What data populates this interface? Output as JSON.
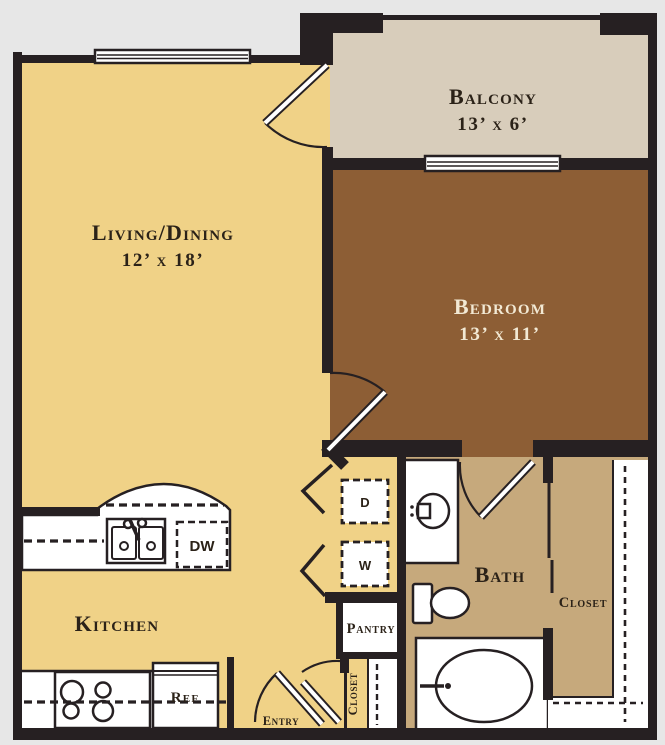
{
  "colors": {
    "background": "#e7e7e7",
    "wall": "#262022",
    "living_floor": "#f0d287",
    "balcony_floor": "#d8cdbb",
    "bedroom_floor": "#8d5e35",
    "bath_floor": "#c6a97c",
    "fixture": "#ffffff",
    "label_dark": "#2b2218",
    "label_light": "#f2e9d4"
  },
  "labels": {
    "living": {
      "name": "Living/Dining",
      "dims": "12’ x 18’"
    },
    "balcony": {
      "name": "Balcony",
      "dims": "13’ x 6’"
    },
    "bedroom": {
      "name": "Bedroom",
      "dims": "13’ x 11’"
    },
    "bath": {
      "name": "Bath"
    },
    "kitchen": {
      "name": "Kitchen"
    },
    "walk_in_closet": {
      "name": "Closet"
    },
    "entry_closet": {
      "name": "Closet"
    },
    "pantry": {
      "name": "Pantry"
    },
    "entry": {
      "name": "Entry"
    },
    "dryer": "D",
    "washer": "W",
    "dishwasher": "DW",
    "refrigerator": "Ref"
  }
}
